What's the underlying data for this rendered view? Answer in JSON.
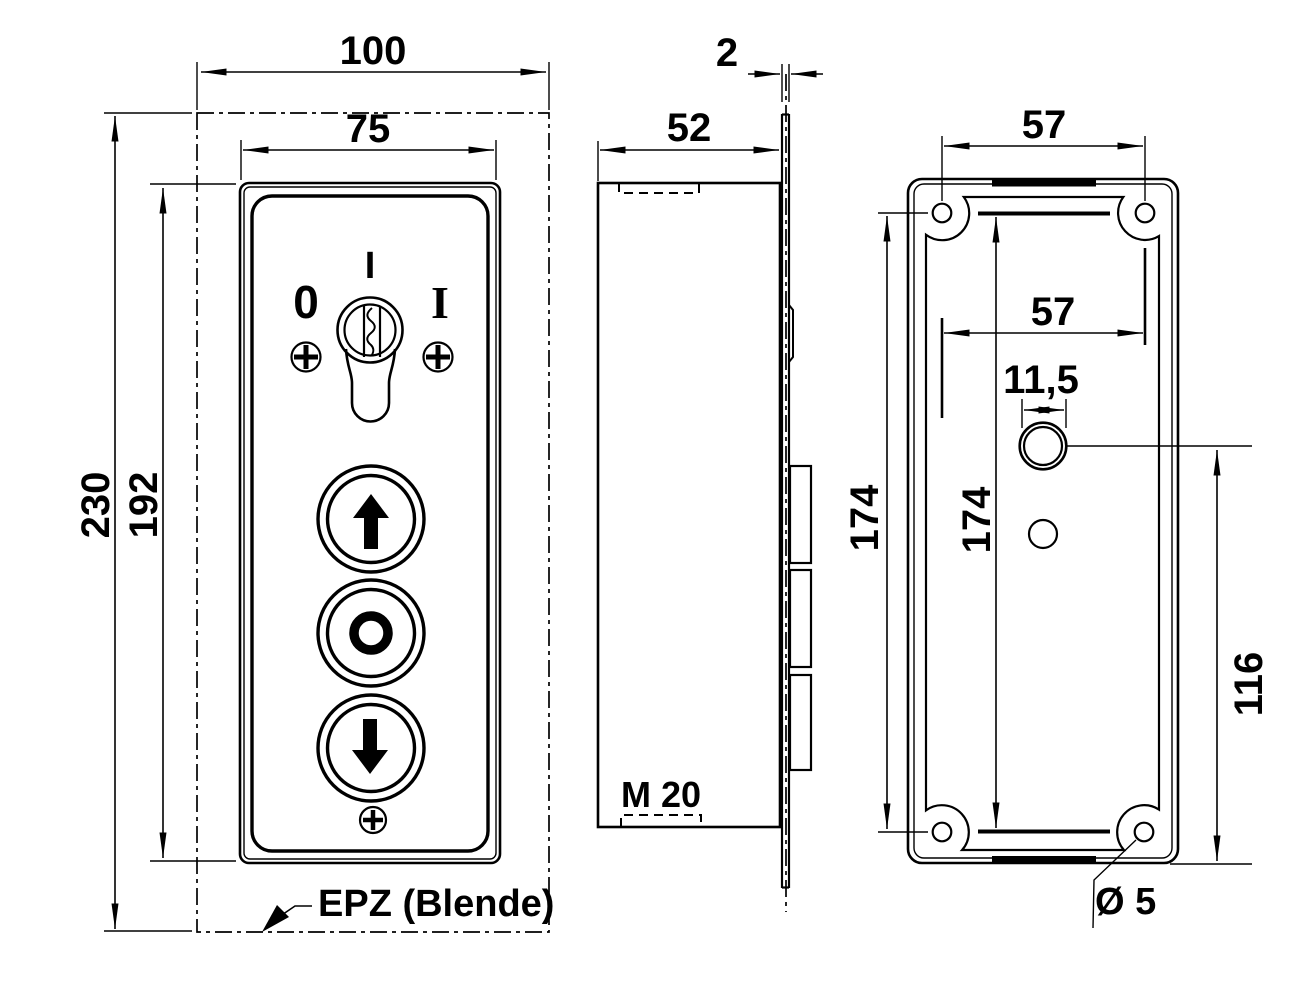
{
  "colors": {
    "line": "#000000",
    "background": "#ffffff"
  },
  "front_view": {
    "dim_outer_width": "100",
    "dim_panel_width": "75",
    "dim_outer_height": "230",
    "dim_panel_height": "192",
    "key_position_top": "I",
    "key_position_left": "0",
    "key_position_right": "I",
    "callout_label": "EPZ (Blende)"
  },
  "side_view": {
    "dim_depth": "52",
    "dim_plate_thickness": "2",
    "cable_gland_label": "M 20"
  },
  "rear_view": {
    "dim_hole_pitch_horizontal": "57",
    "dim_hole_pitch_horizontal_inner": "57",
    "dim_cable_hole_width": "11,5",
    "dim_hole_pitch_vertical": "174",
    "dim_hole_pitch_vertical_inner": "174",
    "dim_cable_hole_offset": "116",
    "dim_screw_hole_diameter": "Ø 5"
  }
}
